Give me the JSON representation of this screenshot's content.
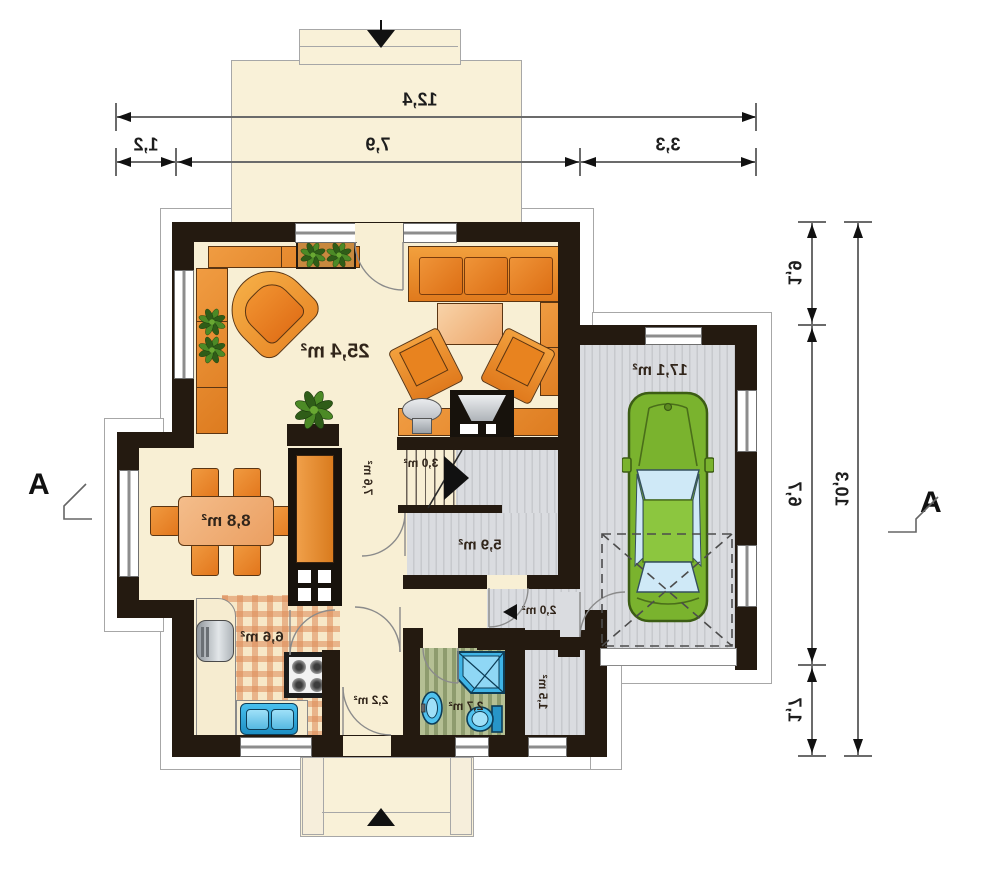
{
  "section": {
    "label": "A"
  },
  "dimensions": {
    "top": {
      "total": "12,4",
      "seg1": "1,2",
      "seg2": "7,9",
      "seg3": "3,3"
    },
    "right": {
      "total": "10,3",
      "seg1": "1,9",
      "seg2": "6,7",
      "seg3": "1,7"
    }
  },
  "rooms": {
    "living": "25,4 m²",
    "dining": "8,8 m²",
    "hall_upper": "7,6 m²",
    "stairs": "3,0 m²",
    "hall": "5,9 m²",
    "kitchen": "6,6 m²",
    "vestibule": "2,2 m²",
    "bathroom": "2,7 m²",
    "garage_lobby": "2,0 m²",
    "storage": "1,5 m²",
    "garage": "17,1 m²"
  },
  "colors": {
    "wall": "#241a10",
    "floor_cream": "#f8efd4",
    "garage_floor": "#dcdee1",
    "bathroom_floor": "#a9b586",
    "kitchen_check": "#dd8a58",
    "furniture_orange": "#e8872c",
    "car_green": "#78b32c",
    "fixture_blue": "#35b2e5",
    "dimension_line": "#6b6b6b"
  }
}
